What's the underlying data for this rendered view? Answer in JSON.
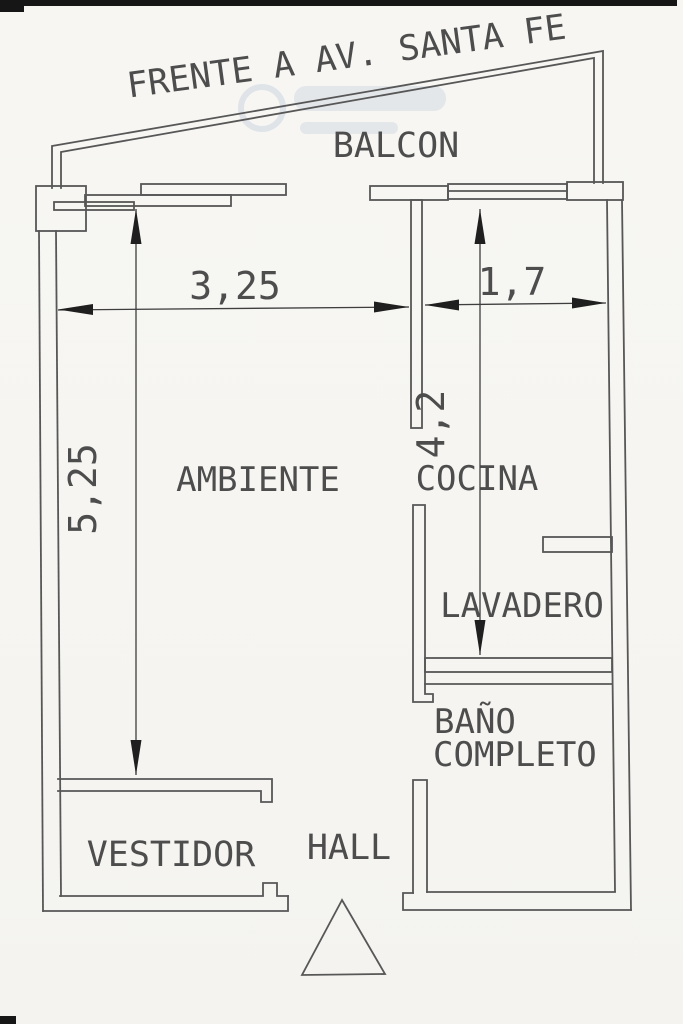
{
  "plan": {
    "street_frontage": "FRENTE A AV. SANTA FE",
    "rooms": {
      "balcony": "BALCON",
      "main_room": "AMBIENTE",
      "kitchen": "COCINA",
      "laundry": "LAVADERO",
      "bathroom_line1": "BAÑO",
      "bathroom_line2": "COMPLETO",
      "dressing_room": "VESTIDOR",
      "hall": "HALL"
    },
    "dimensions_m": {
      "main_room_width": "3,25",
      "main_room_depth": "5,25",
      "kitchen_width": "1,7",
      "kitchen_depth": "4,2"
    }
  },
  "colors": {
    "paper": "#f6f5f1",
    "wall_line": "#575757",
    "dimension_line": "#3e3e3e",
    "arrowhead": "#1f1f1f",
    "text": "#4d4d4d",
    "watermark": "#9fb2cc",
    "scan_mark": "#161616"
  }
}
